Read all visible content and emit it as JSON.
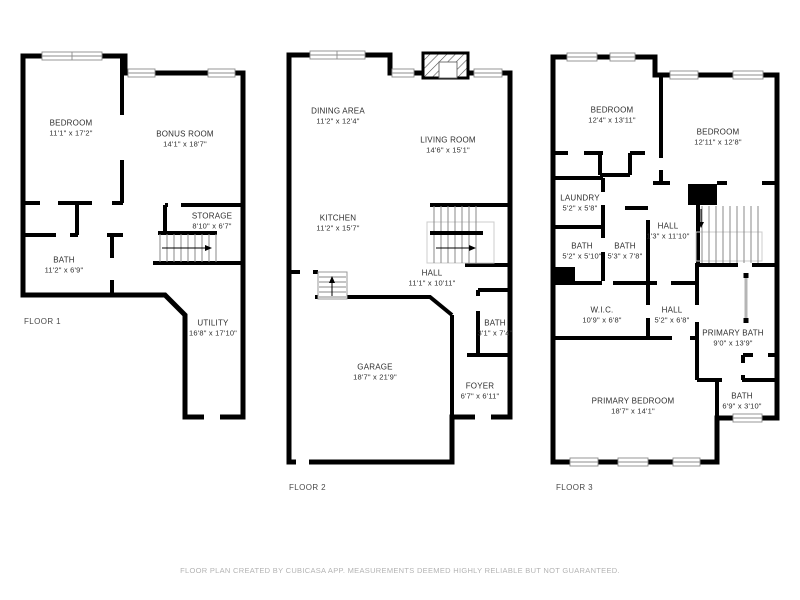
{
  "footer": "FLOOR PLAN CREATED BY CUBICASA APP. MEASUREMENTS DEEMED HIGHLY RELIABLE BUT NOT GUARANTEED.",
  "floors": [
    {
      "label": "FLOOR 1",
      "rooms": [
        {
          "name": "BEDROOM",
          "dims": "11'1\" x 17'2\""
        },
        {
          "name": "BONUS ROOM",
          "dims": "14'1\" x 18'7\""
        },
        {
          "name": "STORAGE",
          "dims": "8'10\" x 6'7\""
        },
        {
          "name": "BATH",
          "dims": "11'2\" x 6'9\""
        },
        {
          "name": "UTILITY",
          "dims": "16'8\" x 17'10\""
        }
      ]
    },
    {
      "label": "FLOOR 2",
      "rooms": [
        {
          "name": "DINING AREA",
          "dims": "11'2\" x 12'4\""
        },
        {
          "name": "LIVING ROOM",
          "dims": "14'6\" x 15'1\""
        },
        {
          "name": "KITCHEN",
          "dims": "11'2\" x 15'7\""
        },
        {
          "name": "HALL",
          "dims": "11'1\" x 10'11\""
        },
        {
          "name": "GARAGE",
          "dims": "18'7\" x 21'9\""
        },
        {
          "name": "BATH",
          "dims": "3'1\" x 7'4\""
        },
        {
          "name": "FOYER",
          "dims": "6'7\" x 6'11\""
        }
      ]
    },
    {
      "label": "FLOOR 3",
      "rooms": [
        {
          "name": "BEDROOM",
          "dims": "12'4\" x 13'11\""
        },
        {
          "name": "BEDROOM",
          "dims": "12'11\" x 12'8\""
        },
        {
          "name": "LAUNDRY",
          "dims": "5'2\" x 5'8\""
        },
        {
          "name": "BATH",
          "dims": "5'2\" x 5'10\""
        },
        {
          "name": "BATH",
          "dims": "5'3\" x 7'8\""
        },
        {
          "name": "HALL",
          "dims": "1'3\" x 11'10\""
        },
        {
          "name": "W.I.C.",
          "dims": "10'9\" x 6'8\""
        },
        {
          "name": "HALL",
          "dims": "5'2\" x 6'8\""
        },
        {
          "name": "PRIMARY BATH",
          "dims": "9'0\" x 13'9\""
        },
        {
          "name": "PRIMARY BEDROOM",
          "dims": "18'7\" x 14'1\""
        },
        {
          "name": "BATH",
          "dims": "6'9\" x 3'10\""
        }
      ]
    }
  ]
}
